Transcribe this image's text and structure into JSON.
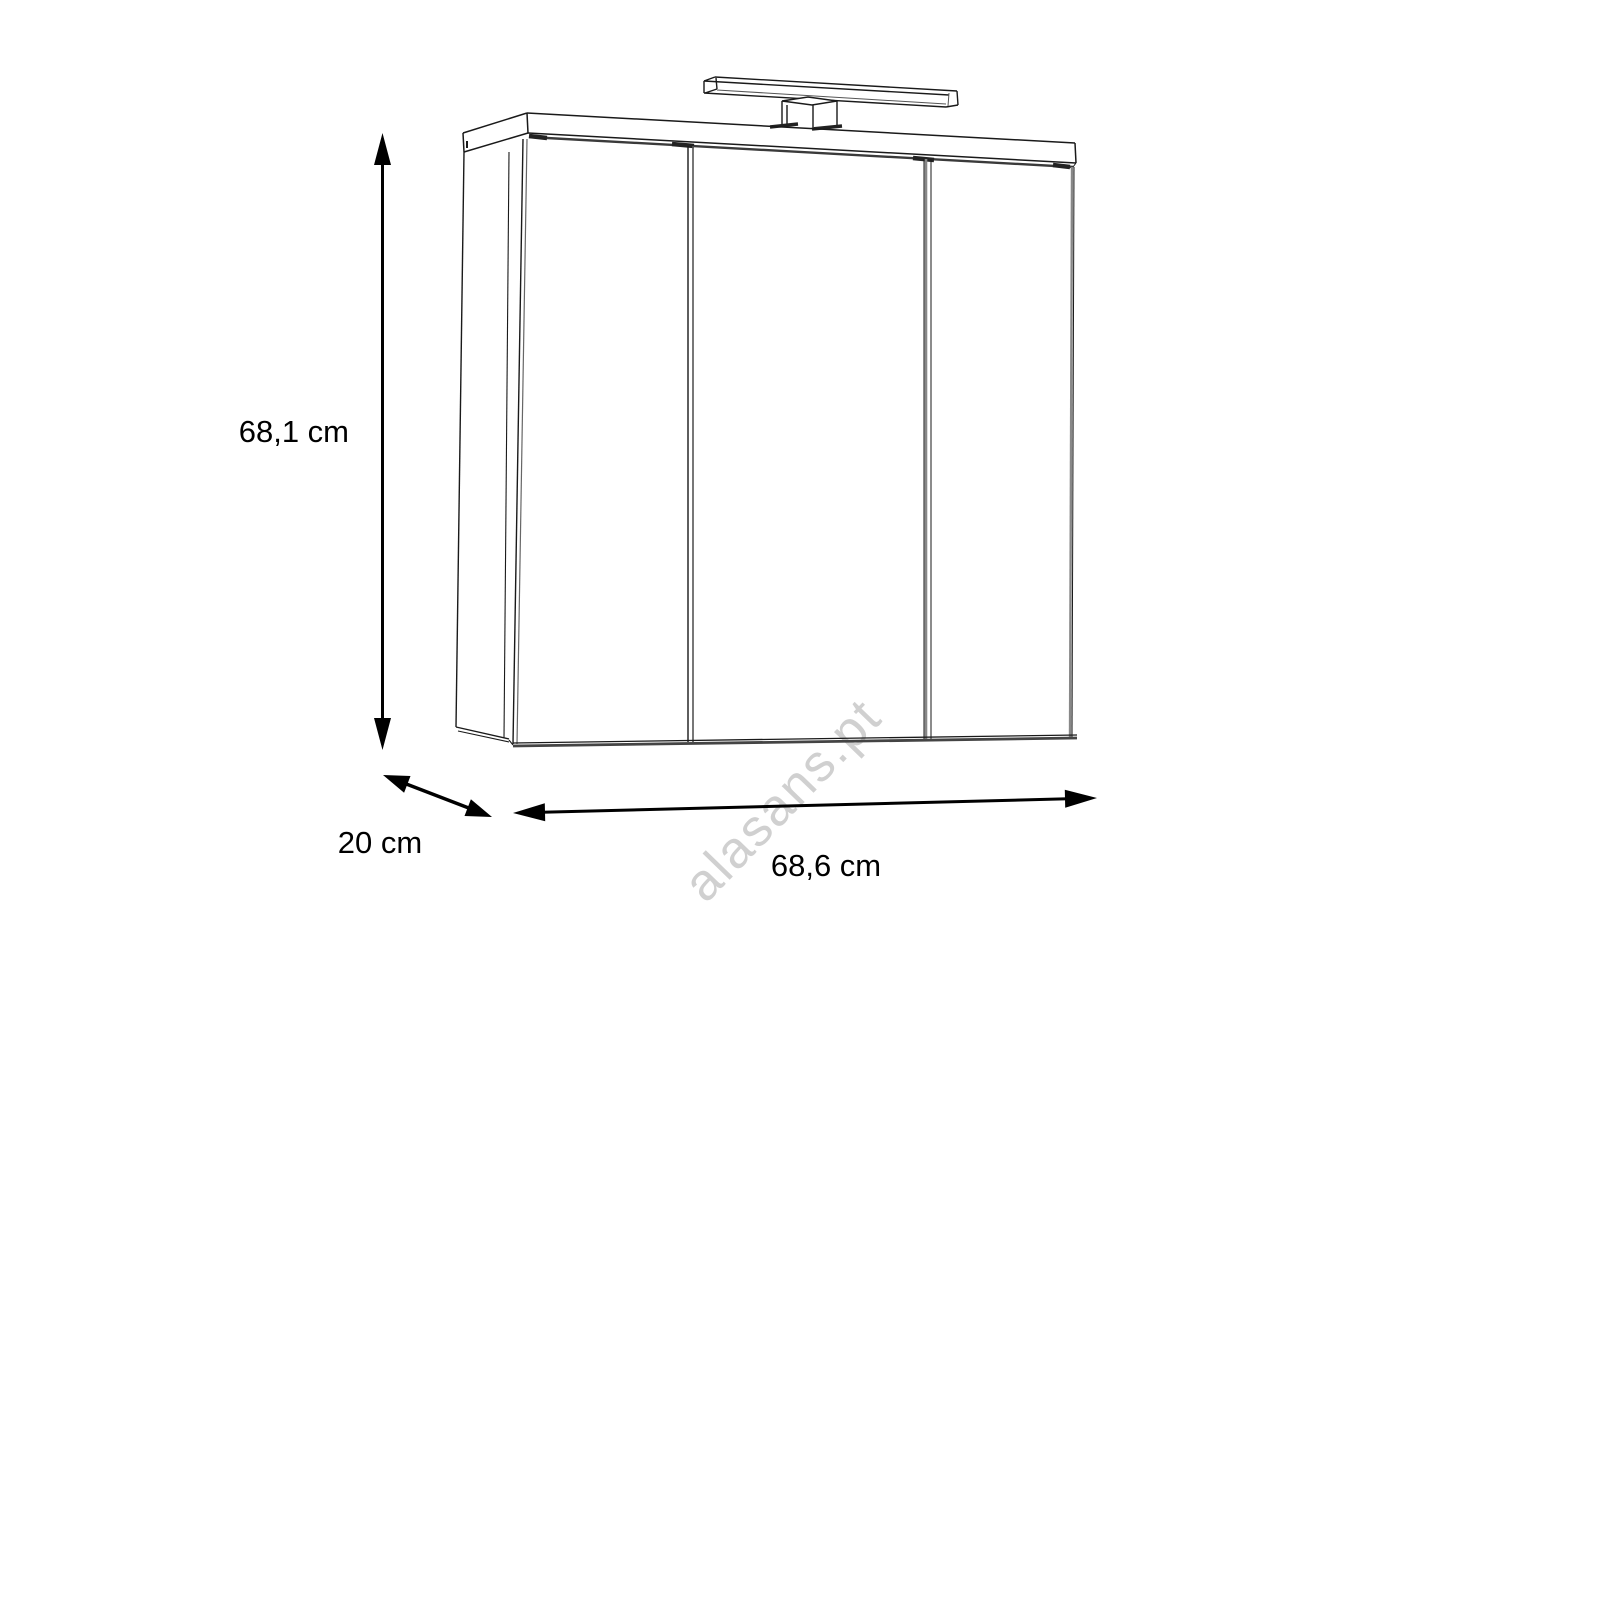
{
  "page": {
    "background_color": "#ffffff",
    "line_color": "#1a1a1a",
    "text_color": "#000000"
  },
  "watermark": {
    "text": "alasans.pt",
    "color": "#d0d0d0"
  },
  "dimensions": {
    "height_label": "68,1 cm",
    "depth_label": "20 cm",
    "width_label": "68,6 cm"
  }
}
